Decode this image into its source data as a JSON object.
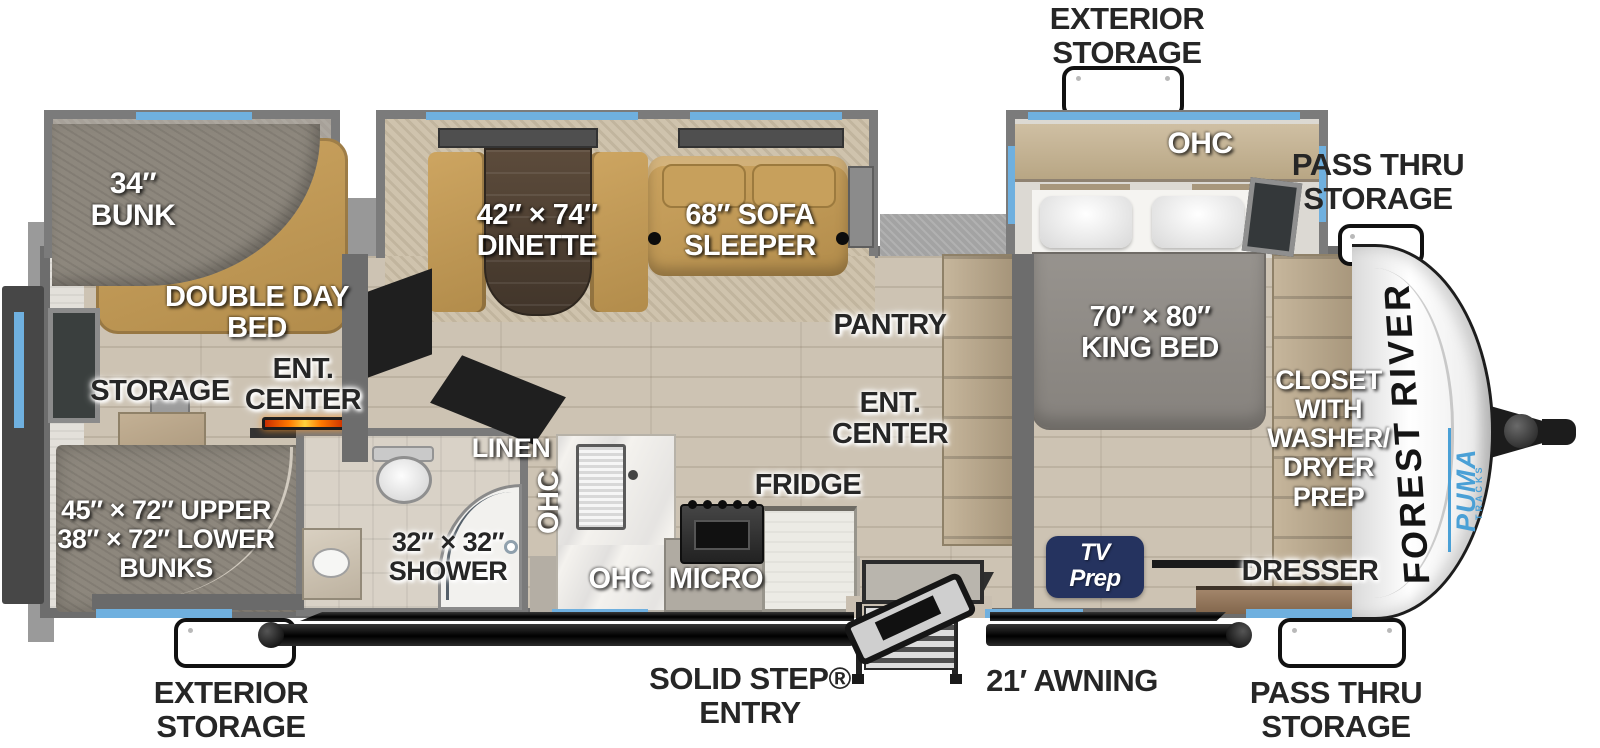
{
  "meta": {
    "title": "Forest River Puma travel trailer floor plan"
  },
  "exterior": {
    "storage_top": "EXTERIOR\nSTORAGE",
    "pass_thru_top": "PASS THRU\nSTORAGE",
    "storage_bottom": "EXTERIOR\nSTORAGE",
    "entry": "SOLID STEP®\nENTRY",
    "awning": "21′ AWNING",
    "pass_thru_bottom": "PASS THRU\nSTORAGE"
  },
  "brand": {
    "maker": "FOREST RIVER",
    "model": "PUMA",
    "model_sub": "TRACKS"
  },
  "bunk_room": {
    "bunk": "34″\nBUNK",
    "day_bed": "DOUBLE DAY\nBED",
    "storage": "STORAGE",
    "ent_center": "ENT.\nCENTER",
    "bunks": "45″ × 72″ UPPER\n38″ × 72″ LOWER\nBUNKS"
  },
  "living": {
    "dinette": "42″ × 74″\nDINETTE",
    "sofa": "68″ SOFA\nSLEEPER",
    "pantry": "PANTRY",
    "ent_center": "ENT.\nCENTER"
  },
  "bath": {
    "linen": "LINEN",
    "shower": "32″ × 32″\nSHOWER"
  },
  "kitchen": {
    "ohc_side": "OHC",
    "ohc": "OHC",
    "micro": "MICRO",
    "fridge": "FRIDGE"
  },
  "bedroom": {
    "ohc": "OHC",
    "king_bed": "70″ × 80″\nKING BED",
    "closet": "CLOSET\nWITH\nWASHER/\nDRYER\nPREP",
    "tv_prep": "TV\nPrep",
    "dresser": "DRESSER"
  },
  "colors": {
    "accent_blue": "#6fb0df",
    "wall_gray": "#6d6d6d",
    "furniture_tan": "#bf9a59",
    "navy_badge": "#25335f",
    "puma_blue": "#4aa0d6",
    "fireplace_orange": "#ff7a00"
  }
}
